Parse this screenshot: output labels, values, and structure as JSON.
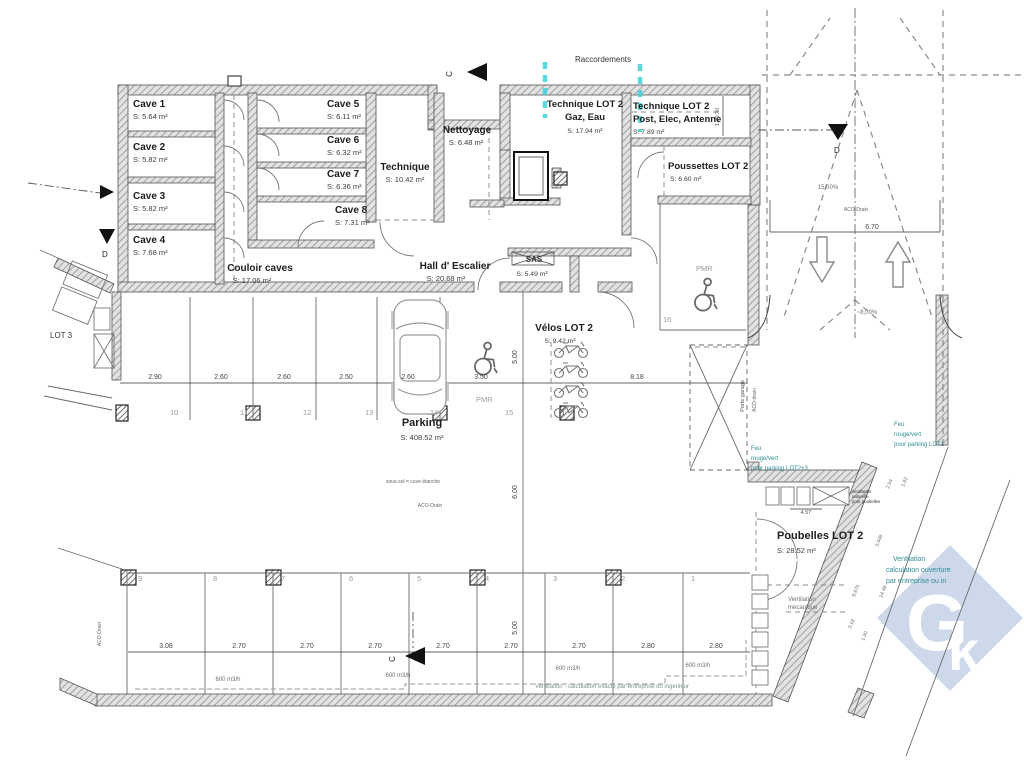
{
  "drawing": {
    "raccordements": "Raccordements",
    "rooms": {
      "cave1": {
        "name": "Cave 1",
        "area": "S: 5.64 m²"
      },
      "cave2": {
        "name": "Cave 2",
        "area": "S: 5.82 m²"
      },
      "cave3": {
        "name": "Cave 3",
        "area": "S: 5.82 m²"
      },
      "cave4": {
        "name": "Cave 4",
        "area": "S: 7.68 m²"
      },
      "cave5": {
        "name": "Cave 5",
        "area": "S: 6.11 m²"
      },
      "cave6": {
        "name": "Cave 6",
        "area": "S: 6.32 m²"
      },
      "cave7": {
        "name": "Cave 7",
        "area": "S: 6.36 m²"
      },
      "cave8": {
        "name": "Cave 8",
        "area": "S: 7.31 m²"
      },
      "couloir": {
        "name": "Couloir caves",
        "area": "S: 17.06 m²"
      },
      "technique": {
        "name": "Technique",
        "area": "S: 10.42 m²"
      },
      "nettoyage": {
        "name": "Nettoyage",
        "area": "S: 6.48 m²"
      },
      "tech_lot2_gaz": {
        "name": "Technique LOT 2",
        "sub": "Gaz, Eau",
        "area": "S: 17.94 m²"
      },
      "tech_lot2_post": {
        "name": "Technique LOT 2",
        "sub": "Post, Elec, Antenne",
        "area": "S: 7.89 m²"
      },
      "poussettes": {
        "name": "Poussettes LOT 2",
        "area": "S: 6.60 m²"
      },
      "hall": {
        "name": "Hall d' Escalier",
        "area": "S: 20.68 m²"
      },
      "sas": {
        "name": "SAS",
        "area": "S: 5.49 m²"
      },
      "velos": {
        "name": "Vélos LOT 2",
        "area": "S: 9.42 m²"
      },
      "parking": {
        "name": "Parking",
        "area": "S: 408.52 m²"
      },
      "poubelles": {
        "name": "Poubelles LOT 2",
        "area": "S: 28.52 m²"
      }
    },
    "parking_upper": {
      "dims": [
        "2.90",
        "2.60",
        "2.60",
        "2.50",
        "2.60",
        "3.50"
      ],
      "dim_right": "8.18",
      "numbers": [
        "10",
        "11",
        "12",
        "13",
        "14",
        "15"
      ],
      "pmr": "PMR",
      "space16": "16"
    },
    "parking_lower": {
      "dims": [
        "3.08",
        "2.70",
        "2.70",
        "2.70",
        "2.70",
        "2.70",
        "2.70",
        "2.80",
        "2.80"
      ],
      "numbers": [
        "9",
        "8",
        "7",
        "6",
        "5",
        "4",
        "3",
        "2",
        "1"
      ]
    },
    "dims": {
      "ramp_width": "6.70",
      "v500": "5.00",
      "v600": "6.00",
      "d457": "4.57",
      "d12030": "1.20.30",
      "diag": [
        "2.54",
        "1.62",
        "3.449",
        "8.675",
        "14.49",
        "1.30",
        "3.19"
      ]
    },
    "slopes": {
      "ramp": "15,00%",
      "garage": "~8,00%"
    },
    "labels": {
      "aco_drain": "ACO-Drain",
      "aco_drain2": "ACO-drain",
      "sous_sol": "sous-sol = cuve étanche",
      "airflow": "600 m3/h",
      "vent_note": "Ventilation - calculation exacte par entreprise ou ingenieur",
      "vent_mech1": "Ventilation",
      "vent_mech2": "mécanique",
      "vent_nat1": "ventilation",
      "vent_nat2": "naturelle",
      "vent_nat3": "pour poubelles",
      "feu2": {
        "l1": "Feu",
        "l2": "rouge/vert",
        "l3": "pour parking LOT2+3"
      },
      "feu1": {
        "l1": "Feu",
        "l2": "rouge/vert",
        "l3": "pour parking LOT1"
      },
      "vent_teal": {
        "l1": "Ventilation",
        "l2": "calculation ouverture",
        "l3": "par entreprise ou in"
      },
      "porte_garage": "Porte garage",
      "lot3": "LOT 3",
      "pmr": "PMR"
    },
    "markers": {
      "c": "C",
      "d": "D"
    },
    "watermark": {
      "g": "G",
      "k": "k"
    },
    "colors": {
      "cyan": "#3fd1d9",
      "teal": "#2e8b93",
      "watermark": "#cdd9ea"
    }
  }
}
